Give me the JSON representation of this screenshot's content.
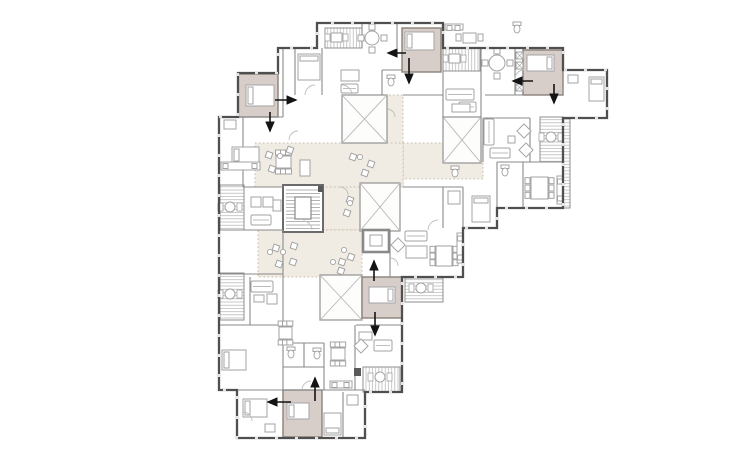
{
  "canvas": {
    "width": 736,
    "height": 459
  },
  "palette": {
    "background": "#ffffff",
    "wall": "#4f4f4f",
    "wall_thin": "#8a8a8a",
    "window_break": "#e4e4e4",
    "furniture": "#a3a3a3",
    "highlight_room_fill": "#d8cec9",
    "highlight_room_stroke": "#8a8179",
    "courtyard_fill": "#f0ebe3",
    "courtyard_dot": "#c6bcaa",
    "hatch_line": "#b0b0b0",
    "hatch_border": "#8f8f8f",
    "shaft_border": "#9a9a9a",
    "shaft_x": "#b8b8b8",
    "arrow": "#141414",
    "dark_block": "#5a5a5a"
  },
  "floorplan": {
    "outline": [
      [
        317,
        23
      ],
      [
        443,
        23
      ],
      [
        443,
        48
      ],
      [
        563,
        48
      ],
      [
        563,
        70
      ],
      [
        607,
        70
      ],
      [
        607,
        118
      ],
      [
        563,
        118
      ],
      [
        563,
        208
      ],
      [
        497,
        208
      ],
      [
        497,
        228
      ],
      [
        463,
        228
      ],
      [
        463,
        277
      ],
      [
        402,
        277
      ],
      [
        402,
        392
      ],
      [
        365,
        392
      ],
      [
        365,
        438
      ],
      [
        237,
        438
      ],
      [
        237,
        390
      ],
      [
        219,
        390
      ],
      [
        219,
        117
      ],
      [
        238,
        117
      ],
      [
        238,
        73
      ],
      [
        278,
        73
      ],
      [
        278,
        48
      ],
      [
        317,
        48
      ]
    ],
    "courtyards": [
      [
        385,
        95,
        18,
        92
      ],
      [
        403,
        143,
        80,
        36
      ],
      [
        255,
        143,
        148,
        44
      ],
      [
        322,
        187,
        40,
        43
      ],
      [
        258,
        230,
        104,
        47
      ]
    ],
    "shafts": [
      [
        342,
        95,
        45,
        48
      ],
      [
        443,
        117,
        38,
        46
      ],
      [
        360,
        183,
        40,
        48
      ],
      [
        320,
        275,
        42,
        45
      ]
    ],
    "stairs": {
      "block": [
        283,
        185,
        40,
        47
      ],
      "landing": [
        295,
        197,
        16,
        22
      ]
    },
    "vestibule": [
      363,
      230,
      26,
      22
    ],
    "highlight_rooms": [
      [
        238,
        74,
        40,
        43
      ],
      [
        402,
        28,
        39,
        44
      ],
      [
        523,
        50,
        40,
        45
      ],
      [
        362,
        277,
        40,
        41
      ],
      [
        283,
        390,
        39,
        47
      ]
    ],
    "balconies": [
      [
        325,
        28,
        37,
        20,
        "v",
        "square",
        331,
        33
      ],
      [
        443,
        48,
        37,
        23,
        "v",
        "square",
        449,
        54
      ],
      [
        563,
        118,
        7,
        90,
        "h",
        "none",
        0,
        0
      ],
      [
        540,
        117,
        23,
        45,
        "h",
        "round",
        546,
        132
      ],
      [
        405,
        278,
        38,
        24,
        "h",
        "round",
        416,
        283
      ],
      [
        363,
        367,
        37,
        25,
        "v",
        "round",
        375,
        372
      ],
      [
        220,
        185,
        24,
        45,
        "h",
        "round",
        225,
        202
      ],
      [
        220,
        273,
        24,
        47,
        "h",
        "round",
        225,
        289
      ]
    ],
    "arrows": [
      [
        275,
        100,
        296,
        100
      ],
      [
        270,
        112,
        270,
        131
      ],
      [
        406,
        53,
        388,
        53
      ],
      [
        409,
        58,
        409,
        83
      ],
      [
        533,
        81,
        513,
        81
      ],
      [
        554,
        84,
        554,
        103
      ],
      [
        374,
        281,
        374,
        261
      ],
      [
        375,
        312,
        375,
        335
      ],
      [
        315,
        401,
        315,
        378
      ],
      [
        291,
        402,
        268,
        402
      ]
    ],
    "walls": [
      [
        238,
        117,
        283,
        117
      ],
      [
        283,
        48,
        283,
        117
      ],
      [
        295,
        48,
        295,
        95
      ],
      [
        322,
        48,
        322,
        95
      ],
      [
        397,
        23,
        397,
        48
      ],
      [
        362,
        23,
        362,
        48
      ],
      [
        443,
        48,
        443,
        118
      ],
      [
        481,
        48,
        481,
        118
      ],
      [
        523,
        48,
        523,
        95
      ],
      [
        515,
        48,
        515,
        95
      ],
      [
        485,
        95,
        523,
        95
      ],
      [
        403,
        95,
        443,
        95
      ],
      [
        382,
        70,
        382,
        95
      ],
      [
        382,
        70,
        402,
        70
      ],
      [
        483,
        118,
        483,
        162
      ],
      [
        530,
        118,
        530,
        162
      ],
      [
        483,
        118,
        530,
        118
      ],
      [
        497,
        162,
        563,
        162
      ],
      [
        497,
        162,
        497,
        228
      ],
      [
        523,
        162,
        523,
        208
      ],
      [
        463,
        187,
        463,
        228
      ],
      [
        443,
        187,
        443,
        228
      ],
      [
        403,
        187,
        463,
        187
      ],
      [
        390,
        230,
        390,
        277
      ],
      [
        219,
        230,
        283,
        230
      ],
      [
        219,
        274,
        283,
        274
      ],
      [
        250,
        277,
        250,
        325
      ],
      [
        219,
        325,
        283,
        325
      ],
      [
        283,
        230,
        283,
        277
      ],
      [
        283,
        277,
        283,
        390
      ],
      [
        283,
        343,
        324,
        343
      ],
      [
        304,
        343,
        304,
        367
      ],
      [
        283,
        367,
        324,
        367
      ],
      [
        324,
        343,
        324,
        390
      ],
      [
        356,
        325,
        402,
        325
      ],
      [
        355,
        325,
        355,
        390
      ],
      [
        343,
        392,
        343,
        438
      ],
      [
        237,
        390,
        365,
        390
      ],
      [
        243,
        117,
        243,
        187
      ],
      [
        243,
        187,
        283,
        187
      ]
    ],
    "beds": [
      [
        298,
        54,
        22,
        26,
        "n"
      ],
      [
        589,
        77,
        15,
        24,
        "n"
      ],
      [
        472,
        196,
        18,
        26,
        "n"
      ],
      [
        222,
        350,
        24,
        20,
        "w"
      ],
      [
        243,
        399,
        24,
        18,
        "w"
      ],
      [
        324,
        413,
        17,
        22,
        "s"
      ],
      [
        246,
        85,
        28,
        21,
        "w"
      ],
      [
        405,
        32,
        29,
        18,
        "w"
      ],
      [
        527,
        55,
        27,
        16,
        "e"
      ],
      [
        369,
        287,
        26,
        16,
        "e"
      ],
      [
        287,
        403,
        22,
        16,
        "w"
      ],
      [
        232,
        147,
        27,
        16,
        "w"
      ]
    ],
    "sofas": [
      [
        341,
        84,
        17,
        9
      ],
      [
        446,
        89,
        28,
        11
      ],
      [
        459,
        102,
        17,
        10
      ],
      [
        405,
        231,
        22,
        10
      ],
      [
        374,
        340,
        18,
        11
      ],
      [
        251,
        215,
        20,
        10
      ],
      [
        251,
        281,
        22,
        11
      ],
      [
        490,
        148,
        20,
        10
      ],
      [
        484,
        119,
        10,
        26
      ]
    ],
    "tables": [
      [
        341,
        70,
        18,
        11
      ],
      [
        406,
        246,
        21,
        12
      ],
      [
        359,
        332,
        13,
        8
      ],
      [
        254,
        295,
        10,
        7
      ],
      [
        273,
        200,
        8,
        11
      ],
      [
        452,
        104,
        18,
        8
      ],
      [
        508,
        136,
        7,
        7
      ],
      [
        224,
        120,
        12,
        9
      ],
      [
        568,
        75,
        10,
        8
      ],
      [
        448,
        191,
        12,
        13
      ],
      [
        347,
        395,
        11,
        10
      ],
      [
        265,
        424,
        10,
        8
      ],
      [
        300,
        160,
        10,
        16
      ]
    ],
    "diamond_chairs": [
      [
        393,
        240
      ],
      [
        356,
        341
      ],
      [
        519,
        126
      ],
      [
        521,
        145
      ]
    ],
    "armchairs": [
      [
        251,
        197
      ],
      [
        263,
        197
      ],
      [
        267,
        294
      ]
    ],
    "dining_sets": [
      [
        276,
        156,
        15,
        12,
        "h"
      ],
      [
        279,
        327,
        13,
        12,
        "h"
      ],
      [
        436,
        246,
        16,
        20,
        "v"
      ],
      [
        531,
        177,
        17,
        22,
        "v"
      ],
      [
        331,
        348,
        14,
        12,
        "h"
      ]
    ],
    "round_tables": [
      [
        372,
        38,
        7
      ],
      [
        497,
        63,
        8
      ]
    ],
    "square_tables": [
      [
        463,
        33,
        13,
        10
      ]
    ],
    "kitchens": [
      [
        221,
        162,
        39,
        8
      ],
      [
        330,
        381,
        22,
        7
      ],
      [
        557,
        176,
        6,
        28
      ],
      [
        445,
        24,
        18,
        6
      ],
      [
        457,
        233,
        6,
        30
      ]
    ],
    "wcs": [
      [
        391,
        80
      ],
      [
        455,
        171
      ],
      [
        505,
        170
      ],
      [
        291,
        352
      ],
      [
        317,
        353
      ],
      [
        517,
        27
      ]
    ],
    "cluster_chairs": [
      [
        273,
        245
      ],
      [
        291,
        243
      ],
      [
        276,
        261
      ],
      [
        290,
        259
      ],
      [
        339,
        259
      ],
      [
        348,
        254
      ],
      [
        338,
        268
      ],
      [
        266,
        152
      ],
      [
        287,
        147
      ],
      [
        269,
        166
      ],
      [
        350,
        154
      ],
      [
        368,
        161
      ],
      [
        362,
        170
      ],
      [
        347,
        197
      ],
      [
        344,
        210
      ]
    ],
    "cluster_circles": [
      [
        283,
        252
      ],
      [
        270,
        252
      ],
      [
        344,
        250
      ],
      [
        280,
        156
      ],
      [
        360,
        157
      ],
      [
        350,
        203
      ],
      [
        333,
        262
      ]
    ],
    "duct_boxes": [
      [
        516,
        52
      ],
      [
        516,
        62
      ],
      [
        516,
        84
      ]
    ],
    "dark_blocks": [
      [
        318,
        186,
        5,
        6
      ],
      [
        354,
        368,
        7,
        8
      ]
    ],
    "door_arcs": [
      "M305,95 a10,10 0 0 1 10,-10",
      "M352,95 a10,10 0 0 0 -10,-10",
      "M289,140 a9,9 0 0 1 9,-9",
      "M312,230 a9,9 0 0 0 -9,-9",
      "M428,230 a10,10 0 0 1 10,-10",
      "M302,390 a9,9 0 0 1 9,-9",
      "M243,412 a9,9 0 0 1 9,9",
      "M524,70 a9,9 0 0 0 -9,9",
      "M563,90 a9,9 0 0 0 -9,9",
      "M390,258 a8,8 0 0 1 8,8",
      "M395,117 a8,8 0 0 0 -8,-8",
      "M340,187 a8,8 0 0 1 8,8"
    ]
  }
}
